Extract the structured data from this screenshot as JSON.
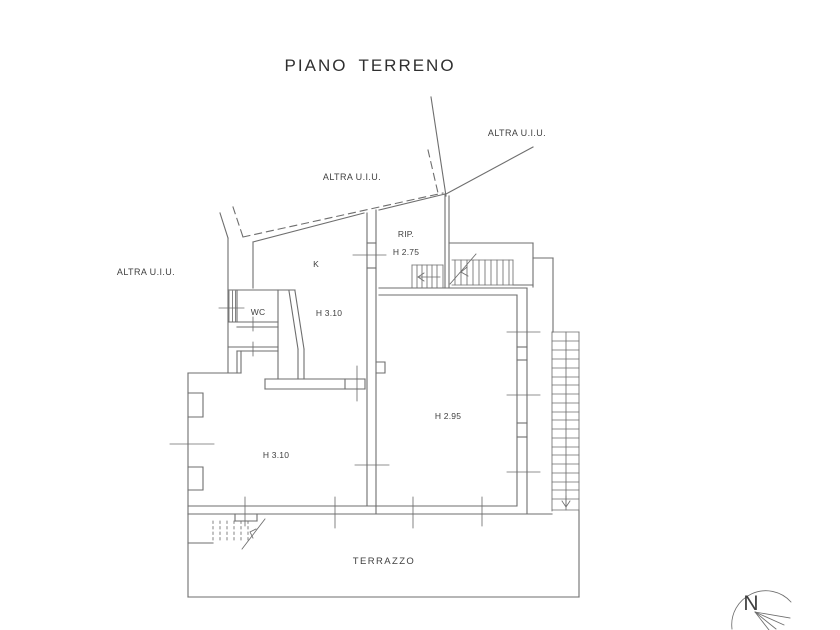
{
  "title": {
    "word1": "PIANO",
    "word2": "TERRENO"
  },
  "labels": {
    "altra_uiu_top_right": "ALTRA U.I.U.",
    "altra_uiu_center": "ALTRA U.I.U.",
    "altra_uiu_left": "ALTRA U.I.U.",
    "rip": "RIP.",
    "rip_height": "H 2.75",
    "kitchen": "K",
    "wc": "WC",
    "hall_height": "H 3.10",
    "living_height": "H 3.10",
    "main_room_height": "H 2.95",
    "terrace": "TERRAZZO",
    "north": "N"
  },
  "colors": {
    "line": "#6e6e6e",
    "text": "#3f3f3f",
    "background": "#ffffff"
  }
}
